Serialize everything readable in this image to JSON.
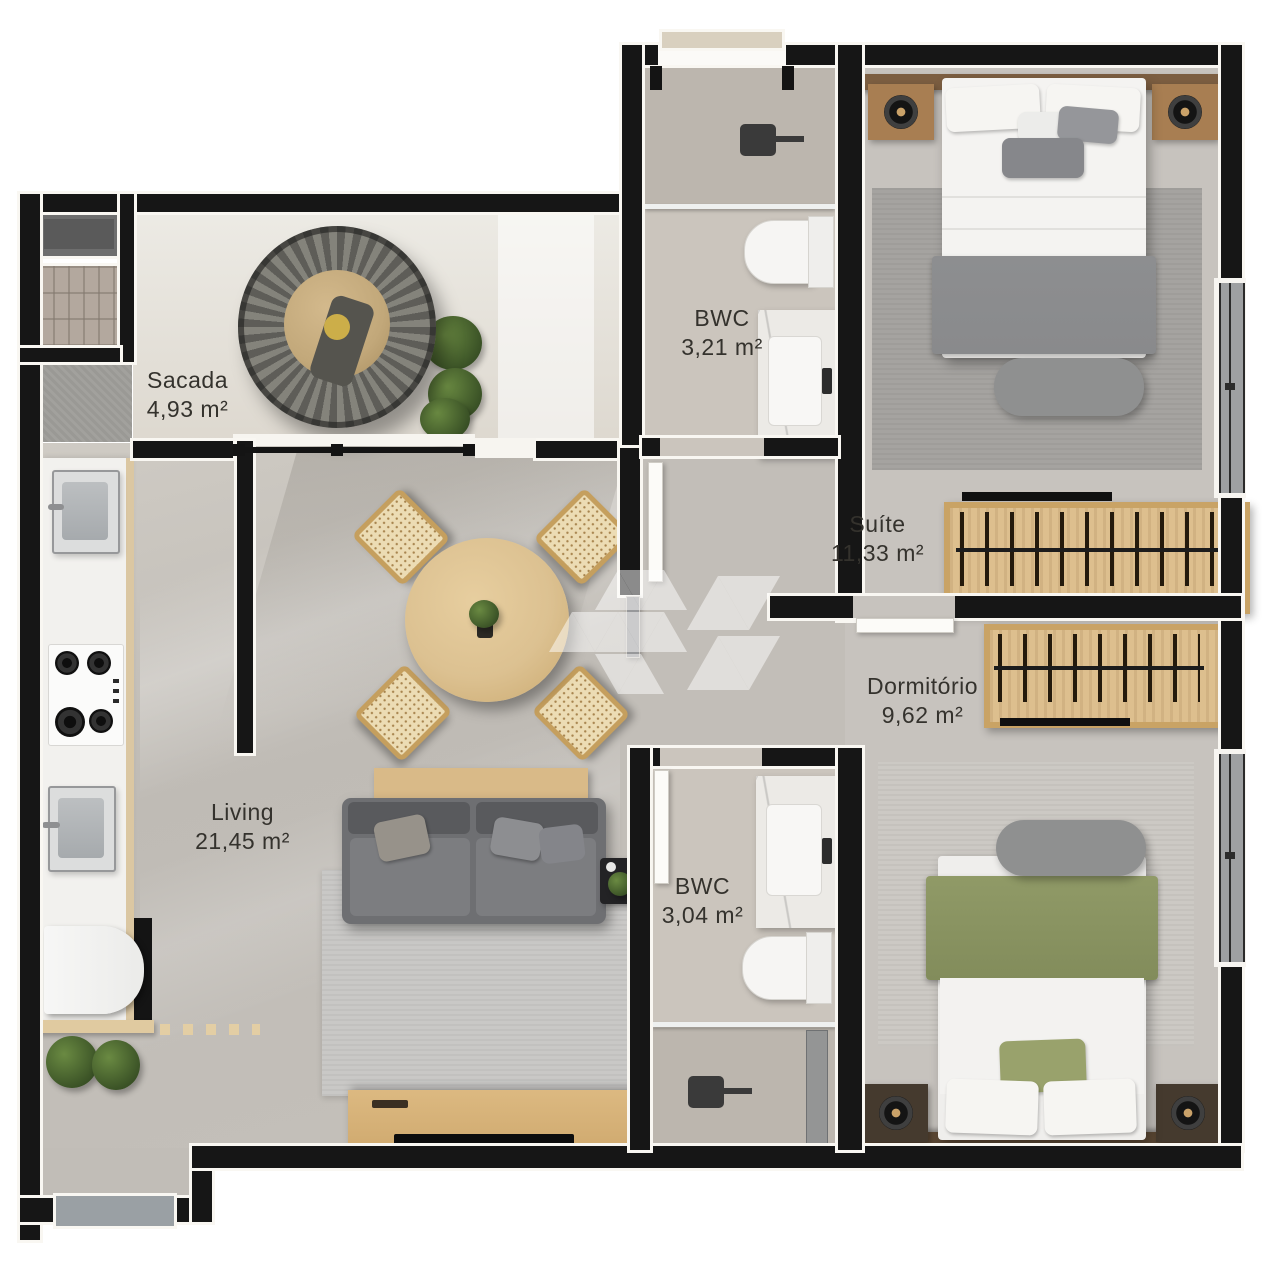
{
  "rooms": [
    {
      "id": "sacada",
      "name": "Sacada",
      "area": "4,93 m²"
    },
    {
      "id": "bwc-superior",
      "name": "BWC",
      "area": "3,21 m²"
    },
    {
      "id": "suite",
      "name": "Suíte",
      "area": "11,33 m²"
    },
    {
      "id": "dormitorio",
      "name": "Dormitório",
      "area": "9,62 m²"
    },
    {
      "id": "living",
      "name": "Living",
      "area": "21,45 m²"
    },
    {
      "id": "bwc-inferior",
      "name": "BWC",
      "area": "3,04 m²"
    }
  ],
  "fixtures": {
    "sacada": [
      "hanging-egg-chair",
      "potted-plants",
      "washing-machine",
      "barbecue-grill",
      "concrete-bench"
    ],
    "kitchen": [
      "kitchen-sink",
      "cooktop-4-burners",
      "service-sink",
      "refrigerator",
      "wood-shelf",
      "floor-plants"
    ],
    "living": [
      "round-dining-table",
      "dining-chairs-4",
      "sideboard",
      "sofa",
      "side-table",
      "area-rug",
      "tv-console",
      "tv"
    ],
    "suite": [
      "double-bed",
      "headboard",
      "nightstands-2",
      "speakers-2",
      "foot-bench",
      "area-rug",
      "open-wardrobe",
      "window"
    ],
    "dormitorio": [
      "double-bed",
      "headboard",
      "nightstands-2",
      "speakers-2",
      "foot-bench",
      "area-rug",
      "open-wardrobe",
      "window"
    ],
    "bwc_superior": [
      "shower-head",
      "glass-partition",
      "toilet",
      "marble-vanity"
    ],
    "bwc_inferior": [
      "shower-head",
      "glass-door",
      "toilet",
      "marble-vanity"
    ],
    "entry": [
      "doormat",
      "entry-door-sill"
    ]
  },
  "watermark": {
    "icon": "triangle-cube-logo"
  },
  "colors": {
    "wall": "#161616",
    "wall_trim": "#f9f7f2",
    "floor_living": "#c3bfb9",
    "floor_sacada": "#e4e0d8",
    "floor_bath": "#cbc5bd",
    "floor_bedroom": "#c7c3be",
    "wood_light": "#ddc08e",
    "wood_medium": "#c49a62",
    "wood_dark": "#5e4a36",
    "sofa": "#6e6f72",
    "blanket_gray": "#8a8b8d",
    "blanket_green": "#87915f",
    "bench": "#8f9090",
    "marble": "#eceae7",
    "window_glass": "#9ea0a2",
    "doormat": "#9aa0a4",
    "label_text": "#34322d"
  }
}
